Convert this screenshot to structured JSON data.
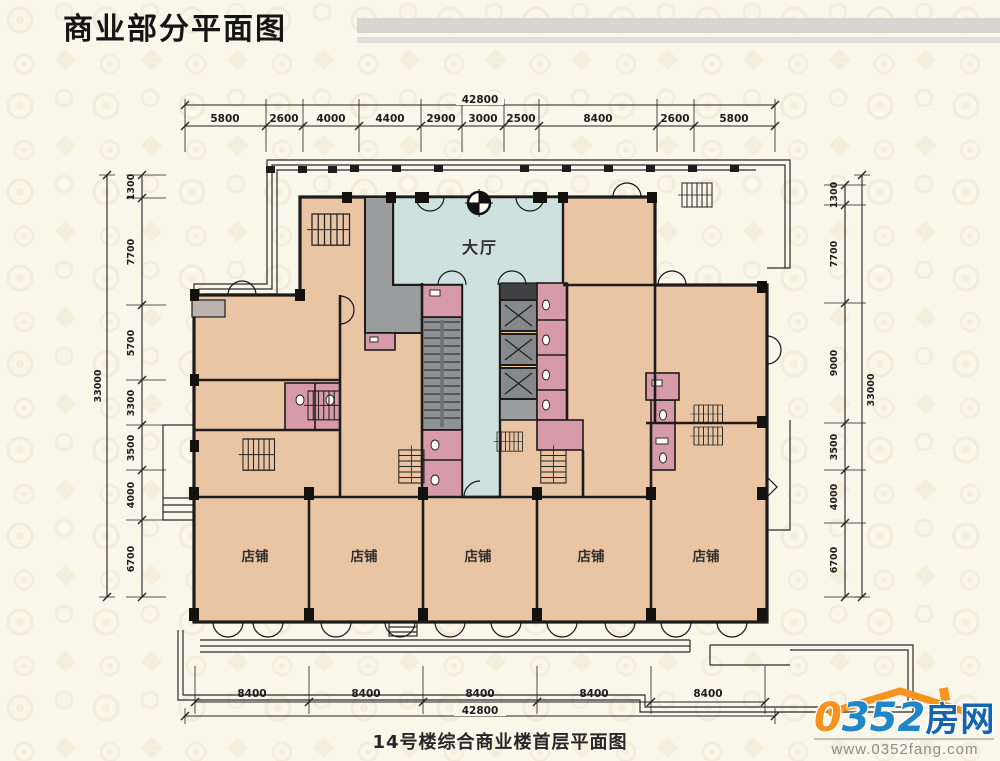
{
  "header": {
    "title": "商业部分平面图"
  },
  "footer": {
    "caption": "14号楼综合商业楼首层平面图"
  },
  "plan": {
    "rooms": {
      "lobby": "大厅",
      "shop": "店铺"
    },
    "dimensions": {
      "top": {
        "total": "42800",
        "segments": [
          "5800",
          "2600",
          "4000",
          "4400",
          "2900",
          "3000",
          "2500",
          "8400",
          "2600",
          "5800"
        ]
      },
      "bottom": {
        "total": "42800",
        "segments": [
          "8400",
          "8400",
          "8400",
          "8400",
          "8400"
        ]
      },
      "left": {
        "total": "33000",
        "segments": [
          "1300",
          "7700",
          "5700",
          "3300",
          "3500",
          "4000",
          "6700"
        ]
      },
      "right": {
        "total": "33000",
        "segments": [
          "1300",
          "7700",
          "9000",
          "3500",
          "4000",
          "6700"
        ]
      }
    }
  },
  "logo": {
    "zero": "0",
    "rest": "352",
    "name": "房网",
    "url": "www.0352fang.com"
  },
  "colors": {
    "background": "#f9f6ea",
    "shop_fill": "#e9c5a4",
    "lobby_fill": "#cfe1de",
    "service_pink": "#d69aa8",
    "circulation_gray": "#9a9d9e",
    "wall": "#1d1c1a",
    "brand_blue": "#1f86c9",
    "brand_orange": "#f6921e"
  }
}
